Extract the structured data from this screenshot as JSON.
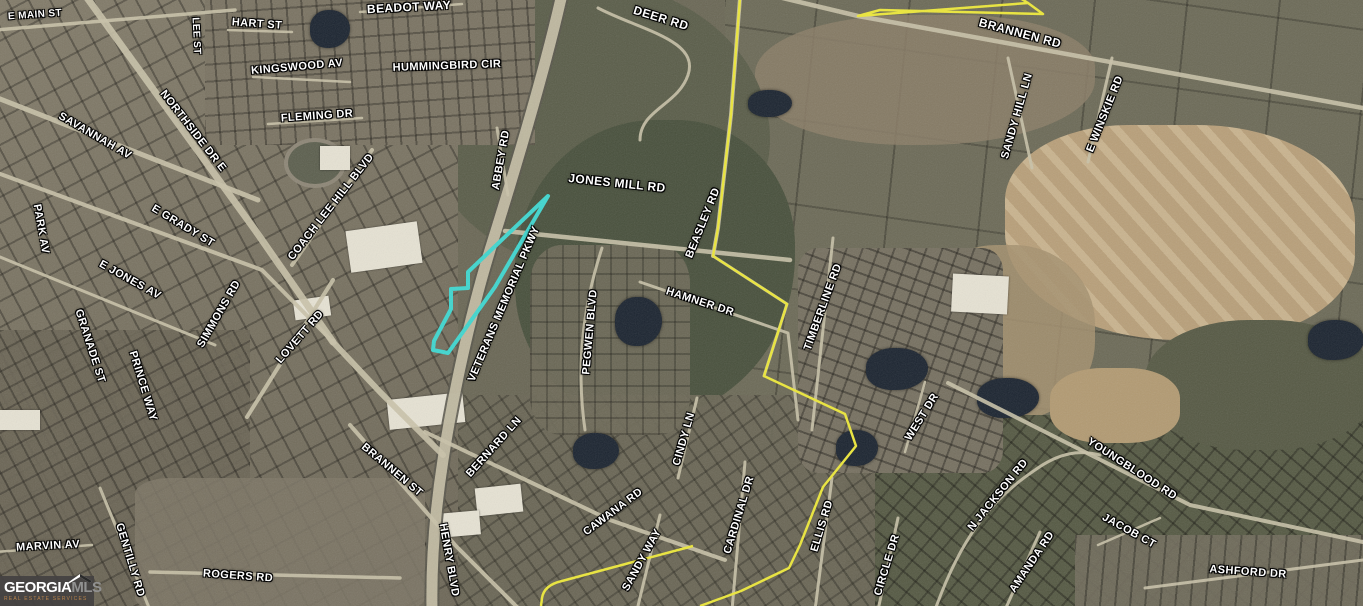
{
  "map": {
    "attribution": {
      "brand_primary": "GEORGIA",
      "brand_secondary": "MLS",
      "tagline": "REAL ESTATE SERVICES"
    },
    "colors": {
      "property_outline": "#3fd6cf",
      "boundary_yellow": "#ece73a",
      "road_light": "#c9c2a8",
      "road_casing": "#59564b",
      "label_text": "#ffffff",
      "label_halo": "#000000",
      "logo_bg": "#444242",
      "logo_brand_primary": "#ffffff",
      "logo_brand_secondary": "#919191",
      "logo_tagline": "#b9834a"
    },
    "labels": [
      {
        "text": "E MAIN ST",
        "x": 35,
        "y": 15,
        "rot": -4,
        "fs": 10
      },
      {
        "text": "HART ST",
        "x": 257,
        "y": 24,
        "rot": 4,
        "fs": 11
      },
      {
        "text": "LEE ST",
        "x": 196,
        "y": 36,
        "rot": 87,
        "fs": 10
      },
      {
        "text": "BEADOT WAY",
        "x": 409,
        "y": 7,
        "rot": -3,
        "fs": 12
      },
      {
        "text": "KINGSWOOD AV",
        "x": 297,
        "y": 67,
        "rot": -5,
        "fs": 11
      },
      {
        "text": "HUMMINGBIRD CIR",
        "x": 447,
        "y": 66,
        "rot": -2,
        "fs": 11
      },
      {
        "text": "FLEMING DR",
        "x": 317,
        "y": 116,
        "rot": -4,
        "fs": 11
      },
      {
        "text": "DEER RD",
        "x": 661,
        "y": 18,
        "rot": 17,
        "fs": 12
      },
      {
        "text": "BRANNEN RD",
        "x": 1020,
        "y": 33,
        "rot": 15,
        "fs": 12
      },
      {
        "text": "SANDY HILL LN",
        "x": 1017,
        "y": 116,
        "rot": -74,
        "fs": 11
      },
      {
        "text": "E WINSKIE RD",
        "x": 1105,
        "y": 114,
        "rot": -68,
        "fs": 11
      },
      {
        "text": "SAVANNAH AV",
        "x": 95,
        "y": 136,
        "rot": 30,
        "fs": 11
      },
      {
        "text": "NORTHSIDE DR E",
        "x": 193,
        "y": 131,
        "rot": 52,
        "fs": 11
      },
      {
        "text": "ABBEY RD",
        "x": 501,
        "y": 160,
        "rot": -80,
        "fs": 11
      },
      {
        "text": "JONES MILL RD",
        "x": 617,
        "y": 183,
        "rot": 6,
        "fs": 12
      },
      {
        "text": "BEASLEY RD",
        "x": 703,
        "y": 223,
        "rot": -68,
        "fs": 11
      },
      {
        "text": "E GRADY ST",
        "x": 183,
        "y": 226,
        "rot": 31,
        "fs": 11
      },
      {
        "text": "PARK AV",
        "x": 41,
        "y": 229,
        "rot": 80,
        "fs": 11
      },
      {
        "text": "COACH LEE HILL BLVD",
        "x": 331,
        "y": 207,
        "rot": -52,
        "fs": 11
      },
      {
        "text": "E JONES AV",
        "x": 130,
        "y": 280,
        "rot": 29,
        "fs": 11
      },
      {
        "text": "SIMMONS RD",
        "x": 219,
        "y": 314,
        "rot": -60,
        "fs": 11
      },
      {
        "text": "GRANADE ST",
        "x": 90,
        "y": 346,
        "rot": 72,
        "fs": 11
      },
      {
        "text": "LOVETT RD",
        "x": 300,
        "y": 337,
        "rot": -49,
        "fs": 11
      },
      {
        "text": "PRINCE WAY",
        "x": 143,
        "y": 386,
        "rot": 73,
        "fs": 11
      },
      {
        "text": "VETERANS MEMORIAL PKWY",
        "x": 504,
        "y": 304,
        "rot": -67,
        "fs": 11
      },
      {
        "text": "PEGWEN BLVD",
        "x": 590,
        "y": 332,
        "rot": -85,
        "fs": 11
      },
      {
        "text": "HAMNER DR",
        "x": 700,
        "y": 302,
        "rot": 18,
        "fs": 11
      },
      {
        "text": "TIMBERLINE RD",
        "x": 823,
        "y": 307,
        "rot": -70,
        "fs": 11
      },
      {
        "text": "CINDY LN",
        "x": 684,
        "y": 439,
        "rot": -74,
        "fs": 11
      },
      {
        "text": "WEST DR",
        "x": 922,
        "y": 417,
        "rot": -58,
        "fs": 11
      },
      {
        "text": "BRANNEN ST",
        "x": 392,
        "y": 470,
        "rot": 40,
        "fs": 11
      },
      {
        "text": "BERNARD LN",
        "x": 494,
        "y": 447,
        "rot": -48,
        "fs": 11
      },
      {
        "text": "CAWANA RD",
        "x": 613,
        "y": 512,
        "rot": -37,
        "fs": 11
      },
      {
        "text": "YOUNGBLOOD RD",
        "x": 1132,
        "y": 469,
        "rot": 33,
        "fs": 11
      },
      {
        "text": "N JACKSON RD",
        "x": 998,
        "y": 495,
        "rot": -51,
        "fs": 11
      },
      {
        "text": "MARVIN AV",
        "x": 48,
        "y": 546,
        "rot": -3,
        "fs": 11
      },
      {
        "text": "GENTILLY RD",
        "x": 130,
        "y": 560,
        "rot": 73,
        "fs": 11
      },
      {
        "text": "HENRY BLVD",
        "x": 449,
        "y": 560,
        "rot": 80,
        "fs": 11
      },
      {
        "text": "SANDY WAY",
        "x": 642,
        "y": 560,
        "rot": -61,
        "fs": 11
      },
      {
        "text": "CARDINAL DR",
        "x": 739,
        "y": 515,
        "rot": -73,
        "fs": 11
      },
      {
        "text": "ELLIS RD",
        "x": 822,
        "y": 526,
        "rot": -73,
        "fs": 11
      },
      {
        "text": "CIRCLE DR",
        "x": 887,
        "y": 565,
        "rot": -73,
        "fs": 11
      },
      {
        "text": "AMANDA RD",
        "x": 1032,
        "y": 562,
        "rot": -56,
        "fs": 11
      },
      {
        "text": "JACOB CT",
        "x": 1129,
        "y": 531,
        "rot": 29,
        "fs": 11
      },
      {
        "text": "ASHFORD DR",
        "x": 1248,
        "y": 572,
        "rot": 4,
        "fs": 11
      },
      {
        "text": "ROGERS RD",
        "x": 238,
        "y": 576,
        "rot": 4,
        "fs": 11
      }
    ],
    "roads": [
      {
        "d": "M562,-6 C545,70 515,170 490,250 C470,315 452,400 443,460 C436,505 431,555 432,610",
        "w": 15,
        "c": "#59564b"
      },
      {
        "d": "M562,-6 C545,70 515,170 490,250 C470,315 452,400 443,460 C436,505 431,555 432,610",
        "w": 11
      },
      {
        "d": "M85,-5 L255,230 L333,342",
        "w": 7
      },
      {
        "d": "M-5,97 L258,200",
        "w": 5
      },
      {
        "d": "M-5,172 L262,270 L333,342",
        "w": 4
      },
      {
        "d": "M-5,30 L235,10",
        "w": 3.5
      },
      {
        "d": "M333,342 L380,392 L443,455",
        "w": 6
      },
      {
        "d": "M247,417 L333,280",
        "w": 4
      },
      {
        "d": "M292,265 L372,150",
        "w": 4
      },
      {
        "d": "M-5,255 L215,345",
        "w": 3
      },
      {
        "d": "M350,425 L455,545 L520,610",
        "w": 4
      },
      {
        "d": "M425,432 L610,520 L725,560",
        "w": 4
      },
      {
        "d": "M505,231 L790,260",
        "w": 4.5
      },
      {
        "d": "M770,-5 L858,16 L1363,108",
        "w": 4.5
      },
      {
        "d": "M740,-2 L731,115 L718,228 L713,256",
        "w": 4
      },
      {
        "d": "M713,256 L787,304 L764,376",
        "w": 3
      },
      {
        "d": "M598,8 C640,30 700,40 688,75 C678,105 640,110 640,140",
        "w": 3
      },
      {
        "d": "M640,282 L788,333 L798,420",
        "w": 3
      },
      {
        "d": "M833,238 L812,430",
        "w": 3
      },
      {
        "d": "M948,383 L1190,505 L1363,542",
        "w": 4
      },
      {
        "d": "M1145,588 L1363,560",
        "w": 3
      },
      {
        "d": "M935,610 C960,540 990,500 1035,470 C1060,452 1080,450 1100,455",
        "w": 3
      },
      {
        "d": "M745,462 L732,610",
        "w": 3
      },
      {
        "d": "M832,478 L815,610",
        "w": 3
      },
      {
        "d": "M898,518 L878,610",
        "w": 3
      },
      {
        "d": "M660,515 L637,610",
        "w": 3
      },
      {
        "d": "M697,398 L678,478",
        "w": 3
      },
      {
        "d": "M602,248 C585,300 575,360 585,430",
        "w": 3
      },
      {
        "d": "M1008,58 L1032,168",
        "w": 3
      },
      {
        "d": "M1112,58 L1088,162",
        "w": 3
      },
      {
        "d": "M253,77 L350,82",
        "w": 2.5
      },
      {
        "d": "M268,124 L362,118",
        "w": 2.5
      },
      {
        "d": "M228,30 L292,32",
        "w": 2.5
      },
      {
        "d": "M360,12 L462,4",
        "w": 2.5
      },
      {
        "d": "M-5,552 L92,545",
        "w": 2.5
      },
      {
        "d": "M150,572 L400,578",
        "w": 3.5
      },
      {
        "d": "M100,488 L150,610",
        "w": 3
      },
      {
        "d": "M1040,532 L1005,610",
        "w": 3
      },
      {
        "d": "M1098,545 L1160,518",
        "w": 2.5
      },
      {
        "d": "M925,382 L905,452",
        "w": 2.5
      },
      {
        "d": "M497,128 L508,195",
        "w": 3
      }
    ],
    "boundaries": {
      "yellow_paths": [
        "M740,-2 L731,115 L718,228 L713,256 L787,304 L764,376 L845,414 L856,446 L823,487 L800,545 L789,568 L741,591 L700,606",
        "M858,16 L1028,3 L1043,14 L880,10 Z",
        "M1028,3 L1020,-2",
        "M693,546 L562,581 Q544,585 542,598 L541,606"
      ]
    },
    "property_outline": {
      "points": "548,196 468,272 468,288 451,289 451,309 434,341 433,350 448,353 495,287"
    }
  }
}
